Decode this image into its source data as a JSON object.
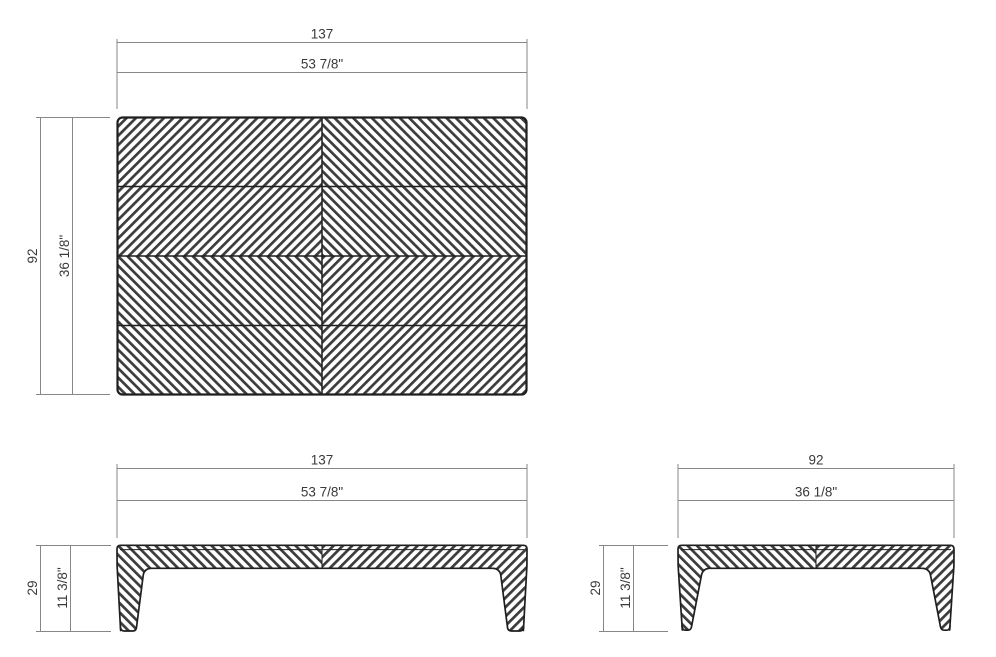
{
  "page": {
    "background": "#ffffff"
  },
  "colors": {
    "background": "#ffffff",
    "object_line": "#1f1f1f",
    "hatch": "#3c3c3c",
    "dimension_line": "#878787",
    "dimension_text": "#3a3a3a"
  },
  "views": {
    "top": {
      "width_cm": "137",
      "width_in": "53 7/8\"",
      "depth_cm": "92",
      "depth_in": "36 1/8\""
    },
    "front": {
      "width_cm": "137",
      "width_in": "53 7/8\"",
      "height_cm": "29",
      "height_in": "11 3/8\""
    },
    "side": {
      "depth_cm": "92",
      "depth_in": "36 1/8\"",
      "height_cm": "29",
      "height_in": "11 3/8\""
    }
  }
}
